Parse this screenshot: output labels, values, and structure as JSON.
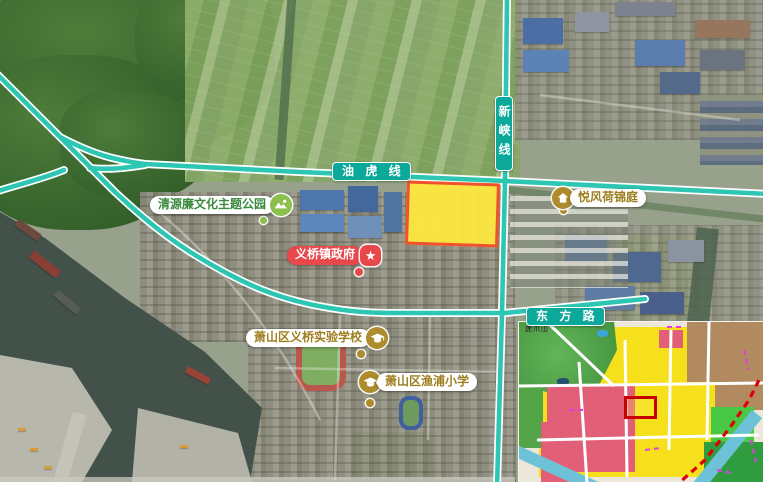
{
  "map": {
    "roads": {
      "youhu": {
        "label": "油 虎 线"
      },
      "xinxia": {
        "label": "新峡线"
      },
      "dongfang": {
        "label": "东 方 路"
      }
    },
    "pois": {
      "park": {
        "label": "清源廉文化主题公园"
      },
      "estate": {
        "label": "悦风荷锦庭"
      },
      "government": {
        "label": "义桥镇政府",
        "star_glyph": "★"
      },
      "school_experimental": {
        "label": "萧山区义桥实验学校"
      },
      "school_primary": {
        "label": "萧山区渔浦小学"
      }
    },
    "inset": {
      "mountain_label": "虎爪山"
    },
    "colors": {
      "road_fill": "#2cc6b2",
      "road_casing": "#ffffff",
      "road_label_bg": "#0ca99b",
      "parcel_fill": "#ffe93d",
      "parcel_border": "#f0512f",
      "poi_green": "#8cbf4e",
      "poi_green_text": "#3a8a3e",
      "poi_gold": "#ae8b2d",
      "poi_gold_text": "#9d7e1e",
      "poi_red": "#e8474b",
      "inset_residential_yellow": "#f6e01c",
      "inset_commercial_pink": "#e25f78",
      "inset_industrial_brown": "#b28a5f",
      "inset_green_space": "#52a447",
      "inset_water_blue": "#6ec2d8",
      "inset_highlight_red": "#c60000"
    }
  }
}
